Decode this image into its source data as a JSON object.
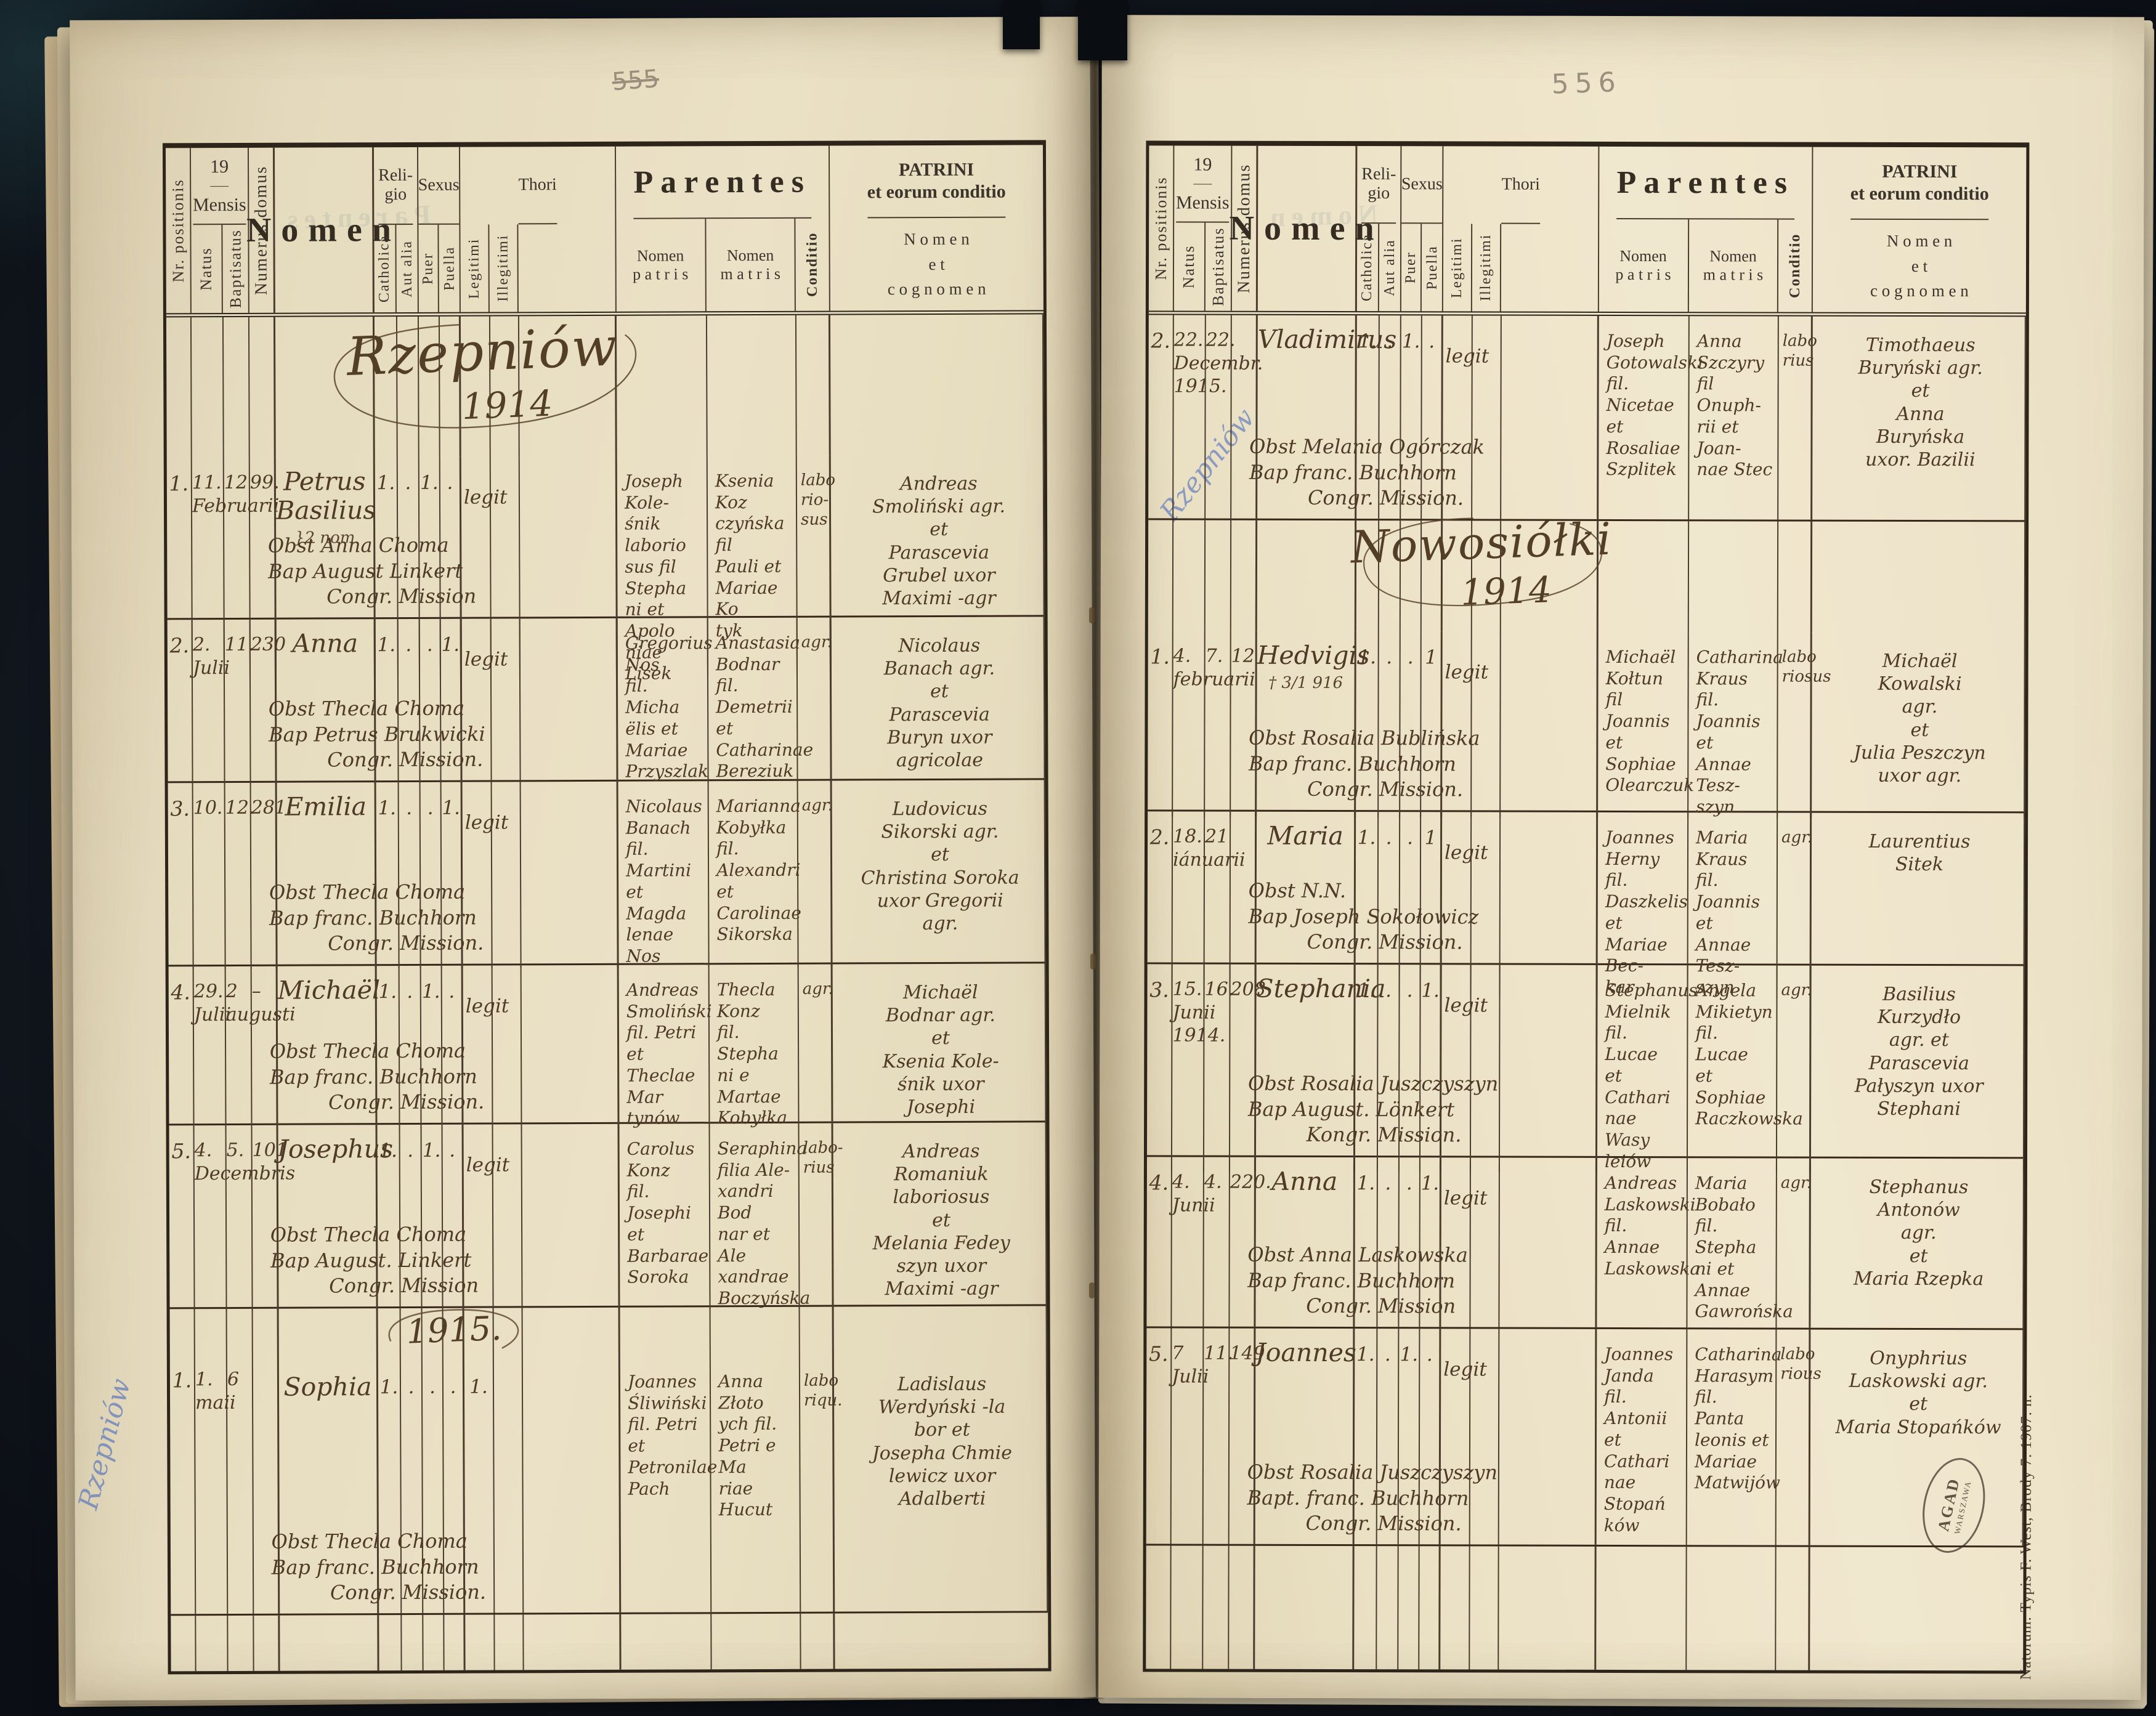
{
  "labels": {
    "year": "19",
    "nr": "Nr. positionis",
    "mensis": "Mensis",
    "natus": "Natus",
    "baptisatus": "Baptisatus",
    "numerus": "Numerus domus",
    "nomen": "Nomen",
    "religio": "Reli-\ngio",
    "catholica": "Catholica",
    "aut_alia": "Aut alia",
    "sexus": "Sexus",
    "puer": "Puer",
    "puella": "Puella",
    "thori": "Thori",
    "legitimi": "Legitimi",
    "illegitimi": "Illegitimi",
    "parentes": "Parentes",
    "patris": "Nomen\np a t r i s",
    "matris": "Nomen\nm a t r i s",
    "conditio": "Conditio",
    "patrini_title": "PATRINI\net eorum conditio",
    "patrini_sub": "N o m e n\ne t\nc o g n o m e n"
  },
  "stamp": {
    "text": "AGAD",
    "side": "WARSZAWA"
  },
  "imprint": "Natorum. Typis F. West, Brody 7. 1907. n.",
  "left": {
    "folio": "555",
    "note": "Rzepniów",
    "title_name": "Rzepniów",
    "title_year": "1914",
    "title2": "1915.",
    "rows": [
      {
        "nr": "1.",
        "natus": "11.\nFebruarii",
        "bapt": "12",
        "num": "99.",
        "name": "Petrus\nBasilius",
        "note": "}2 nom",
        "m_cath": "1.",
        "m_aut": ".",
        "m_puer": "1.",
        "m_puella": ".",
        "m_leg": "",
        "legit": "legit",
        "pater": "Joseph Kole-\nśnik laborio\nsus fil Stepha\nni et Apolo\nniae Lisek",
        "mater": "Ksenia Koz\nczyńska fil\nPauli et\nMariae Ko\ntyk",
        "cond": "labo\nrio-\nsus",
        "patrini": "Andreas\nSmoliński agr.\net\nParascevia\nGrubel uxor\nMaximi -agr",
        "obst": "Obst Anna Choma",
        "bap": "Bap August Linkert",
        "congr": "Congr. Mission"
      },
      {
        "nr": "2.",
        "natus": "2.\nJulii",
        "bapt": "11.",
        "num": "230",
        "name": "Anna",
        "note": "",
        "m_cath": "1.",
        "m_aut": ".",
        "m_puer": ".",
        "m_puella": "1.",
        "m_leg": "",
        "legit": "legit",
        "pater": "Gregorius Nos\nfil. Micha\nëlis et Mariae\nPrzyszlak",
        "mater": "Anastasia\nBodnar\nfil. Demetrii\net Catharinae\nBereziuk",
        "cond": "agr.",
        "patrini": "Nicolaus\nBanach agr.\net\nParascevia\nBuryn uxor\nagricolae",
        "obst": "Obst Thecla Choma",
        "bap": "Bap Petrus Brukwicki",
        "congr": "Congr. Mission."
      },
      {
        "nr": "3.",
        "natus": "10.",
        "bapt": "12.",
        "num": "281.",
        "name": "Emilia",
        "note": "",
        "m_cath": "1.",
        "m_aut": ".",
        "m_puer": ".",
        "m_puella": "1.",
        "m_leg": "",
        "legit": "legit",
        "pater": "Nicolaus\nBanach\nfil. Martini\net Magda\nlenae Nos",
        "mater": "Marianna\nKobyłka fil.\nAlexandri\net Carolinae\nSikorska",
        "cond": "agr.",
        "patrini": "Ludovicus\nSikorski agr.\net\nChristina Soroka\nuxor Gregorii\nagr.",
        "obst": "Obst Thecla Choma",
        "bap": "Bap franc. Buchhorn",
        "congr": "Congr. Mission."
      },
      {
        "nr": "4.",
        "natus": "29.\nJulii",
        "bapt": "2\naugusti",
        "num": "–",
        "name": "Michaël",
        "note": "",
        "m_cath": "1.",
        "m_aut": ".",
        "m_puer": "1.",
        "m_puella": ".",
        "m_leg": "",
        "legit": "legit",
        "pater": "Andreas\nSmoliński\nfil. Petri et\nTheclae Mar\ntynów",
        "mater": "Thecla Konz\nfil. Stepha\nni e Martae\nKobyłka",
        "cond": "agr.",
        "patrini": "Michaël\nBodnar agr.\net\nKsenia Kole-\nśnik uxor\nJosephi",
        "obst": "Obst Thecla Choma",
        "bap": "Bap franc. Buchhorn",
        "congr": "Congr. Mission."
      },
      {
        "nr": "5.",
        "natus": "4.\nDecembris",
        "bapt": "5.",
        "num": "101.",
        "name": "Josephus",
        "note": "",
        "m_cath": "1.",
        "m_aut": ".",
        "m_puer": "1.",
        "m_puella": ".",
        "m_leg": "",
        "legit": "legit",
        "pater": "Carolus Konz\nfil. Josephi\net Barbarae\nSoroka",
        "mater": "Seraphina\nfilia Ale-\nxandri Bod\nnar et Ale\nxandrae\nBoczyńska",
        "cond": "labo-\nrius",
        "patrini": "Andreas\nRomaniuk\nlaboriosus\net\nMelania Fedey\nszyn uxor\nMaximi -agr",
        "obst": "Obst Thecla Choma",
        "bap": "Bap August. Linkert",
        "congr": "Congr. Mission"
      },
      {
        "nr": "1.",
        "natus": "1.\nmaii",
        "bapt": "6",
        "num": "",
        "name": "Sophia",
        "note": "",
        "m_cath": "1.",
        "m_aut": ".",
        "m_puer": ".",
        "m_puella": ".",
        "m_leg": "1.",
        "legit": "",
        "pater": "Joannes\nŚliwiński\nfil. Petri\net Petronilae\nPach",
        "mater": "Anna Złoto\nych fil.\nPetri e Ma\nriae Hucut",
        "cond": "labo\nriqu.",
        "patrini": "Ladislaus\nWerdyński -la\nbor et\nJosepha Chmie\nlewicz uxor\nAdalberti",
        "obst": "Obst Thecla Choma",
        "bap": "Bap franc. Buchhorn",
        "congr": "Congr. Mission."
      }
    ]
  },
  "right": {
    "folio": "556",
    "note": "Rzepniów",
    "title_name": "Nowosiółki",
    "title_year": "1914",
    "rows": [
      {
        "nr": "2.",
        "natus": "22.\nDecembr.\n1915.",
        "bapt": "22.",
        "num": "",
        "name": "Vladimirus",
        "note": "",
        "m_cath": "1.",
        "m_aut": ".",
        "m_puer": "1.",
        "m_puella": ".",
        "m_leg": "",
        "legit": "legit",
        "pater": "Joseph\nGotowalski\nfil. Nicetae\net Rosaliae\nSzplitek",
        "mater": "Anna Szczyry\nfil Onuph-\nrii et Joan-\nnae Stec",
        "cond": "labo\nrius",
        "patrini": "Timothaeus\nBuryński agr.\net\nAnna\nBuryńska\nuxor. Bazilii",
        "obst": "Obst Melania Ogórczak",
        "bap": "Bap franc. Buchhorn",
        "congr": "Congr. Mission."
      },
      {
        "nr": "1.",
        "natus": "4.\nfebruarii",
        "bapt": "7.",
        "num": "12",
        "name": "Hedvigis",
        "note": "† 3/1 916",
        "m_cath": "1.",
        "m_aut": ".",
        "m_puer": ".",
        "m_puella": "1",
        "m_leg": "",
        "legit": "legit",
        "pater": "Michaël\nKołtun\nfil Joannis\net Sophiae\nOlearczuk",
        "mater": "Catharina\nKraus fil.\nJoannis et\nAnnae Tesz-\nszyn .",
        "cond": "labo\nriosus",
        "patrini": "Michaël\nKowalski\nagr.\net\nJulia Peszczyn\nuxor agr.",
        "obst": "Obst Rosalia Bublińska",
        "bap": "Bap franc. Buchhorn",
        "congr": "Congr. Mission."
      },
      {
        "nr": "2.",
        "natus": "18.\niánuarii",
        "bapt": "21",
        "num": "",
        "name": "Maria",
        "note": "",
        "m_cath": "1.",
        "m_aut": ".",
        "m_puer": ".",
        "m_puella": "1",
        "m_leg": "",
        "legit": "legit",
        "pater": "Joannes\nHerny fil.\nDaszkelis et\nMariae Bec-\nkar",
        "mater": "Maria\nKraus fil.\nJoannis et\nAnnae Tesz-\nszyn",
        "cond": "agr.",
        "patrini": "Laurentius\nSitek",
        "obst": "Obst N.N.",
        "bap": "Bap Joseph Sokołowicz",
        "congr": "Congr. Mission."
      },
      {
        "nr": "3.",
        "natus": "15.\nJunii\n1914.",
        "bapt": "16.",
        "num": "208",
        "name": "Stephania",
        "note": "",
        "m_cath": "1.",
        "m_aut": ".",
        "m_puer": ".",
        "m_puella": "1.",
        "m_leg": "",
        "legit": "legit",
        "pater": "Stephanus\nMielnik\nfil. Lucae\net Cathari\nnae Wasy\nleiów",
        "mater": "Angela\nMikietyn\nfil. Lucae\net Sophiae\nRaczkowska",
        "cond": "agr.",
        "patrini": "Basilius\nKurzydło\nagr. et\nParascevia\nPałyszyn uxor\nStephani",
        "obst": "Obst Rosalia Juszczyszyn",
        "bap": "Bap August. Lönkert",
        "congr": "Kongr. Mission."
      },
      {
        "nr": "4.",
        "natus": "4.\nJunii",
        "bapt": "4.",
        "num": "220.",
        "name": "Anna",
        "note": "",
        "m_cath": "1.",
        "m_aut": ".",
        "m_puer": ".",
        "m_puella": "1.",
        "m_leg": "",
        "legit": "legit",
        "pater": "Andreas\nLaskowski\nfil. Annae\nLaskowska",
        "mater": "Maria\nBobało\nfil. Stepha\nni et Annae\nGawrońska",
        "cond": "agr.",
        "patrini": "Stephanus\nAntonów\nagr.\net\nMaria Rzepka",
        "obst": "Obst Anna Laskowska",
        "bap": "Bap franc. Buchhorn",
        "congr": "Congr. Mission"
      },
      {
        "nr": "5.",
        "natus": "7\nJulii",
        "bapt": "11.",
        "num": "149.",
        "name": "Joannes",
        "note": "",
        "m_cath": "1.",
        "m_aut": ".",
        "m_puer": "1.",
        "m_puella": ".",
        "m_leg": "",
        "legit": "legit",
        "pater": "Joannes\nJanda\nfil. Antonii\net Cathari\nnae Stopań\nków",
        "mater": "Catharina\nHarasym\nfil. Panta\nleonis et\nMariae\nMatwijów",
        "cond": "labo\nrious",
        "patrini": "Onyphrius\nLaskowski agr.\net\nMaria Stopańków",
        "obst": "Obst Rosalia Juszczyszyn",
        "bap": "Bapt. franc. Buchhorn",
        "congr": "Congr. Mission."
      }
    ]
  }
}
